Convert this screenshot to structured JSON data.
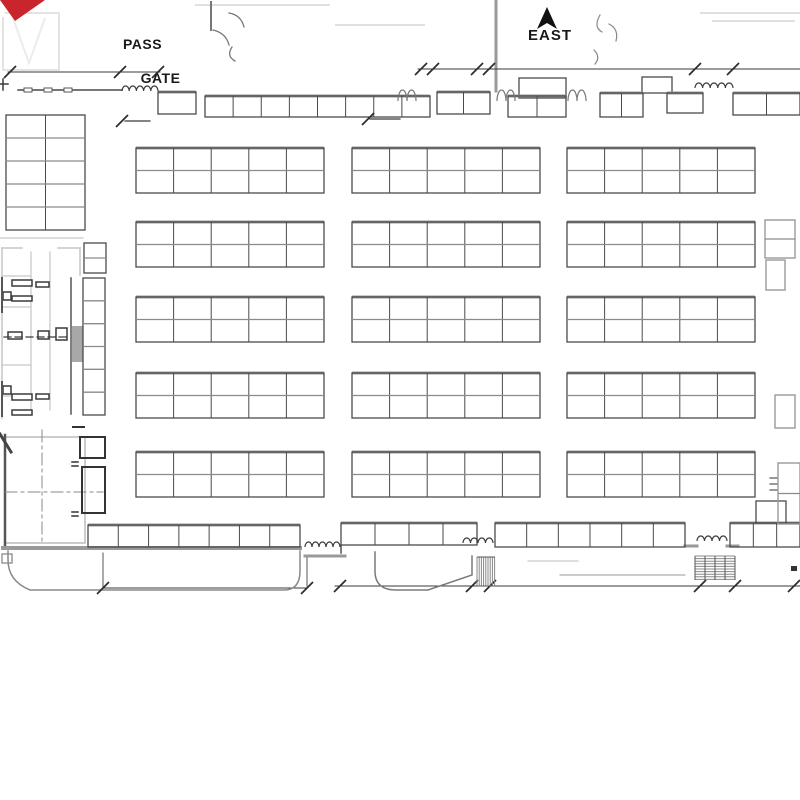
{
  "labels": {
    "pass_gate_line1": "PASS",
    "pass_gate_line2": "GATE",
    "compass": "EAST"
  },
  "colors": {
    "red": "#c9252c",
    "ink": "#1a1a1a",
    "dark": "#4a4a4a",
    "mid": "#777777",
    "gray": "#999999",
    "room": "#333333",
    "light": "#c6c6c6",
    "faint": "#e0e0e0"
  },
  "plan": {
    "booth_blocks": [
      {
        "x": 136,
        "y": 148,
        "w": 188,
        "h": 45,
        "c": 5,
        "r": 2,
        "s": "dark",
        "tb": true
      },
      {
        "x": 352,
        "y": 148,
        "w": 188,
        "h": 45,
        "c": 5,
        "r": 2,
        "s": "dark",
        "tb": true
      },
      {
        "x": 567,
        "y": 148,
        "w": 188,
        "h": 45,
        "c": 5,
        "r": 2,
        "s": "dark",
        "tb": true
      },
      {
        "x": 136,
        "y": 222,
        "w": 188,
        "h": 45,
        "c": 5,
        "r": 2,
        "s": "dark",
        "tb": true
      },
      {
        "x": 352,
        "y": 222,
        "w": 188,
        "h": 45,
        "c": 5,
        "r": 2,
        "s": "dark",
        "tb": true
      },
      {
        "x": 567,
        "y": 222,
        "w": 188,
        "h": 45,
        "c": 5,
        "r": 2,
        "s": "dark",
        "tb": true
      },
      {
        "x": 136,
        "y": 297,
        "w": 188,
        "h": 45,
        "c": 5,
        "r": 2,
        "s": "dark",
        "tb": true
      },
      {
        "x": 352,
        "y": 297,
        "w": 188,
        "h": 45,
        "c": 5,
        "r": 2,
        "s": "dark",
        "tb": true
      },
      {
        "x": 567,
        "y": 297,
        "w": 188,
        "h": 45,
        "c": 5,
        "r": 2,
        "s": "dark",
        "tb": true
      },
      {
        "x": 136,
        "y": 373,
        "w": 188,
        "h": 45,
        "c": 5,
        "r": 2,
        "s": "dark",
        "tb": true
      },
      {
        "x": 352,
        "y": 373,
        "w": 188,
        "h": 45,
        "c": 5,
        "r": 2,
        "s": "dark",
        "tb": true
      },
      {
        "x": 567,
        "y": 373,
        "w": 188,
        "h": 45,
        "c": 5,
        "r": 2,
        "s": "dark",
        "tb": true
      },
      {
        "x": 136,
        "y": 452,
        "w": 188,
        "h": 45,
        "c": 5,
        "r": 2,
        "s": "dark",
        "tb": true
      },
      {
        "x": 352,
        "y": 452,
        "w": 188,
        "h": 45,
        "c": 5,
        "r": 2,
        "s": "dark",
        "tb": true
      },
      {
        "x": 567,
        "y": 452,
        "w": 188,
        "h": 45,
        "c": 5,
        "r": 2,
        "s": "dark",
        "tb": true
      },
      {
        "x": 6,
        "y": 115,
        "w": 79,
        "h": 115,
        "c": 2,
        "r": 5,
        "s": "dark",
        "tb": false
      },
      {
        "x": 83,
        "y": 278,
        "w": 22,
        "h": 137,
        "c": 1,
        "r": 6,
        "s": "dark",
        "tb": false
      },
      {
        "x": 84,
        "y": 243,
        "w": 22,
        "h": 30,
        "c": 1,
        "r": 2,
        "s": "dark",
        "tb": false
      },
      {
        "x": 205,
        "y": 96,
        "w": 225,
        "h": 21,
        "c": 8,
        "r": 1,
        "s": "dark",
        "tb": true
      },
      {
        "x": 158,
        "y": 92,
        "w": 38,
        "h": 22,
        "c": 1,
        "r": 1,
        "s": "dark",
        "tb": true
      },
      {
        "x": 437,
        "y": 92,
        "w": 53,
        "h": 22,
        "c": 2,
        "r": 1,
        "s": "dark",
        "tb": true
      },
      {
        "x": 519,
        "y": 78,
        "w": 47,
        "h": 20,
        "c": 1,
        "r": 1,
        "s": "dark",
        "tb": false
      },
      {
        "x": 508,
        "y": 96,
        "w": 58,
        "h": 21,
        "c": 2,
        "r": 1,
        "s": "dark",
        "tb": true
      },
      {
        "x": 642,
        "y": 77,
        "w": 30,
        "h": 16,
        "c": 1,
        "r": 1,
        "s": "dark",
        "tb": false
      },
      {
        "x": 600,
        "y": 93,
        "w": 43,
        "h": 24,
        "c": 2,
        "r": 1,
        "s": "dark",
        "tb": true
      },
      {
        "x": 667,
        "y": 93,
        "w": 36,
        "h": 20,
        "c": 1,
        "r": 1,
        "s": "dark",
        "tb": true
      },
      {
        "x": 733,
        "y": 93,
        "w": 67,
        "h": 22,
        "c": 2,
        "r": 1,
        "s": "dark",
        "tb": true
      },
      {
        "x": 88,
        "y": 525,
        "w": 212,
        "h": 22,
        "c": 7,
        "r": 1,
        "s": "dark",
        "tb": true
      },
      {
        "x": 341,
        "y": 523,
        "w": 136,
        "h": 22,
        "c": 4,
        "r": 1,
        "s": "dark",
        "tb": true
      },
      {
        "x": 495,
        "y": 523,
        "w": 190,
        "h": 24,
        "c": 6,
        "r": 1,
        "s": "dark",
        "tb": true
      },
      {
        "x": 730,
        "y": 523,
        "w": 70,
        "h": 24,
        "c": 3,
        "r": 1,
        "s": "dark",
        "tb": true
      },
      {
        "x": 756,
        "y": 501,
        "w": 30,
        "h": 22,
        "c": 1,
        "r": 1,
        "s": "dark",
        "tb": false
      },
      {
        "x": 80,
        "y": 437,
        "w": 25,
        "h": 21,
        "c": 1,
        "r": 1,
        "s": "room",
        "tb": false
      },
      {
        "x": 82,
        "y": 467,
        "w": 23,
        "h": 46,
        "c": 1,
        "r": 1,
        "s": "room",
        "tb": false
      },
      {
        "x": 765,
        "y": 220,
        "w": 30,
        "h": 38,
        "c": 1,
        "r": 2,
        "s": "gray",
        "tb": false
      },
      {
        "x": 766,
        "y": 260,
        "w": 19,
        "h": 30,
        "c": 1,
        "r": 1,
        "s": "gray",
        "tb": false
      },
      {
        "x": 775,
        "y": 395,
        "w": 20,
        "h": 33,
        "c": 1,
        "r": 1,
        "s": "gray",
        "tb": false
      },
      {
        "x": 778,
        "y": 463,
        "w": 22,
        "h": 61,
        "c": 1,
        "r": 2,
        "s": "gray",
        "tb": false
      }
    ],
    "dimension_ticks": [
      {
        "x": 10,
        "y": 72
      },
      {
        "x": 120,
        "y": 72
      },
      {
        "x": 158,
        "y": 72
      },
      {
        "x": 421,
        "y": 69
      },
      {
        "x": 433,
        "y": 69
      },
      {
        "x": 477,
        "y": 69
      },
      {
        "x": 489,
        "y": 69
      },
      {
        "x": 695,
        "y": 69
      },
      {
        "x": 733,
        "y": 69
      },
      {
        "x": 122,
        "y": 121
      },
      {
        "x": 368,
        "y": 119
      },
      {
        "x": 103,
        "y": 588
      },
      {
        "x": 307,
        "y": 588
      },
      {
        "x": 340,
        "y": 586
      },
      {
        "x": 472,
        "y": 586
      },
      {
        "x": 490,
        "y": 586
      },
      {
        "x": 700,
        "y": 586
      },
      {
        "x": 735,
        "y": 586
      },
      {
        "x": 794,
        "y": 586
      }
    ],
    "fences": [
      {
        "x": 122,
        "y": 91,
        "n": 5,
        "bw": 7.2,
        "bh": 5
      },
      {
        "x": 695,
        "y": 88,
        "n": 5,
        "bw": 7.6,
        "bh": 5
      },
      {
        "x": 305,
        "y": 547,
        "n": 5,
        "bw": 7.0,
        "bh": 5
      },
      {
        "x": 463,
        "y": 543,
        "n": 4,
        "bw": 7.5,
        "bh": 5
      },
      {
        "x": 697,
        "y": 541,
        "n": 4,
        "bw": 7.5,
        "bh": 5
      }
    ],
    "door_arcs": [
      {
        "x": 398,
        "y": 101,
        "n": 2,
        "bw": 9,
        "bh": 11
      },
      {
        "x": 497,
        "y": 101,
        "n": 2,
        "bw": 9,
        "bh": 11
      },
      {
        "x": 568,
        "y": 101,
        "n": 2,
        "bw": 9,
        "bh": 11
      }
    ],
    "stair_hatches": [
      {
        "x": 477,
        "y": 557,
        "w": 18,
        "h": 29,
        "dir": "v",
        "step": 2.2
      },
      {
        "x": 695,
        "y": 556,
        "w": 40,
        "h": 24,
        "dir": "h",
        "step": 2.6
      }
    ]
  }
}
